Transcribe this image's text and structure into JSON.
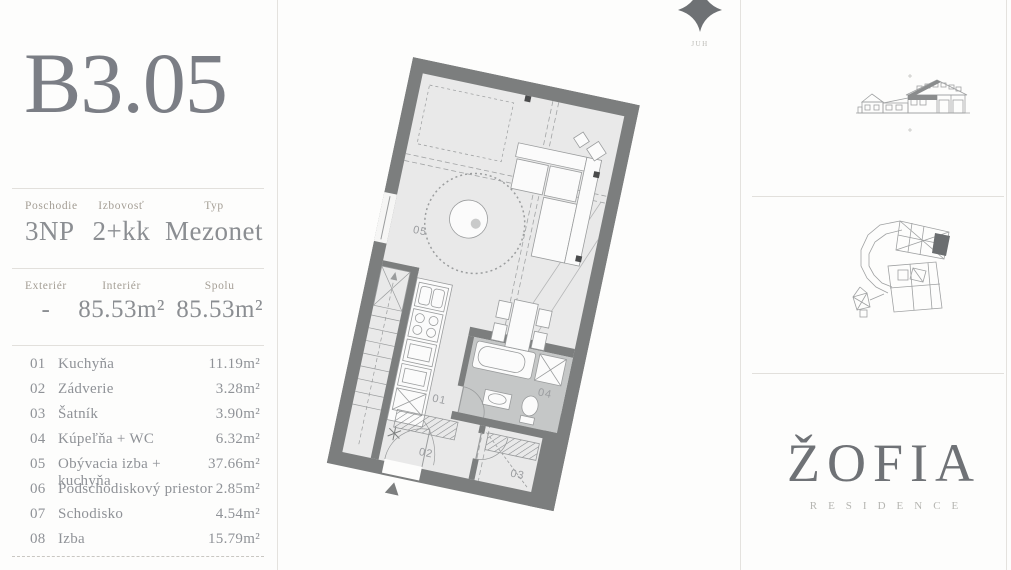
{
  "colors": {
    "title": "#7b7e85",
    "label": "#a49e95",
    "value": "#8b8e92",
    "divider": "#e2e0dc",
    "plan_wall": "#7c7e7e",
    "plan_floor": "#e9e9e9",
    "plan_bathroom": "#c5c7c7",
    "logo": "#6f7276",
    "logo_sub": "#b5b5b1"
  },
  "sidebar": {
    "unit": "B3.05",
    "stats": [
      {
        "label": "Poschodie",
        "value": "3NP"
      },
      {
        "label": "Izbovosť",
        "value": "2+kk"
      },
      {
        "label": "Typ",
        "value": "Mezonet"
      }
    ],
    "areas": [
      {
        "label": "Exteriér",
        "value": "-"
      },
      {
        "label": "Interiér",
        "value": "85.53m²"
      },
      {
        "label": "Spolu",
        "value": "85.53m²"
      }
    ],
    "rooms": [
      {
        "num": "01",
        "name": "Kuchyňa",
        "area": "11.19m²"
      },
      {
        "num": "02",
        "name": "Zádverie",
        "area": "3.28m²"
      },
      {
        "num": "03",
        "name": "Šatník",
        "area": "3.90m²"
      },
      {
        "num": "04",
        "name": "Kúpeľňa + WC",
        "area": "6.32m²"
      },
      {
        "num": "05",
        "name": "Obývacia izba + kuchyňa",
        "area": "37.66m²"
      },
      {
        "num": "06",
        "name": "Podschodiskový priestor",
        "area": "2.85m²"
      },
      {
        "num": "07",
        "name": "Schodisko",
        "area": "4.54m²"
      },
      {
        "num": "08",
        "name": "Izba",
        "area": "15.79m²"
      }
    ]
  },
  "compass": {
    "label": "JUH"
  },
  "plan": {
    "room_labels": {
      "r01": "01",
      "r02": "02",
      "r03": "03",
      "r04": "04",
      "r05": "05"
    }
  },
  "logo": {
    "name": "ŽOFIA",
    "subtitle": "RESIDENCE"
  }
}
